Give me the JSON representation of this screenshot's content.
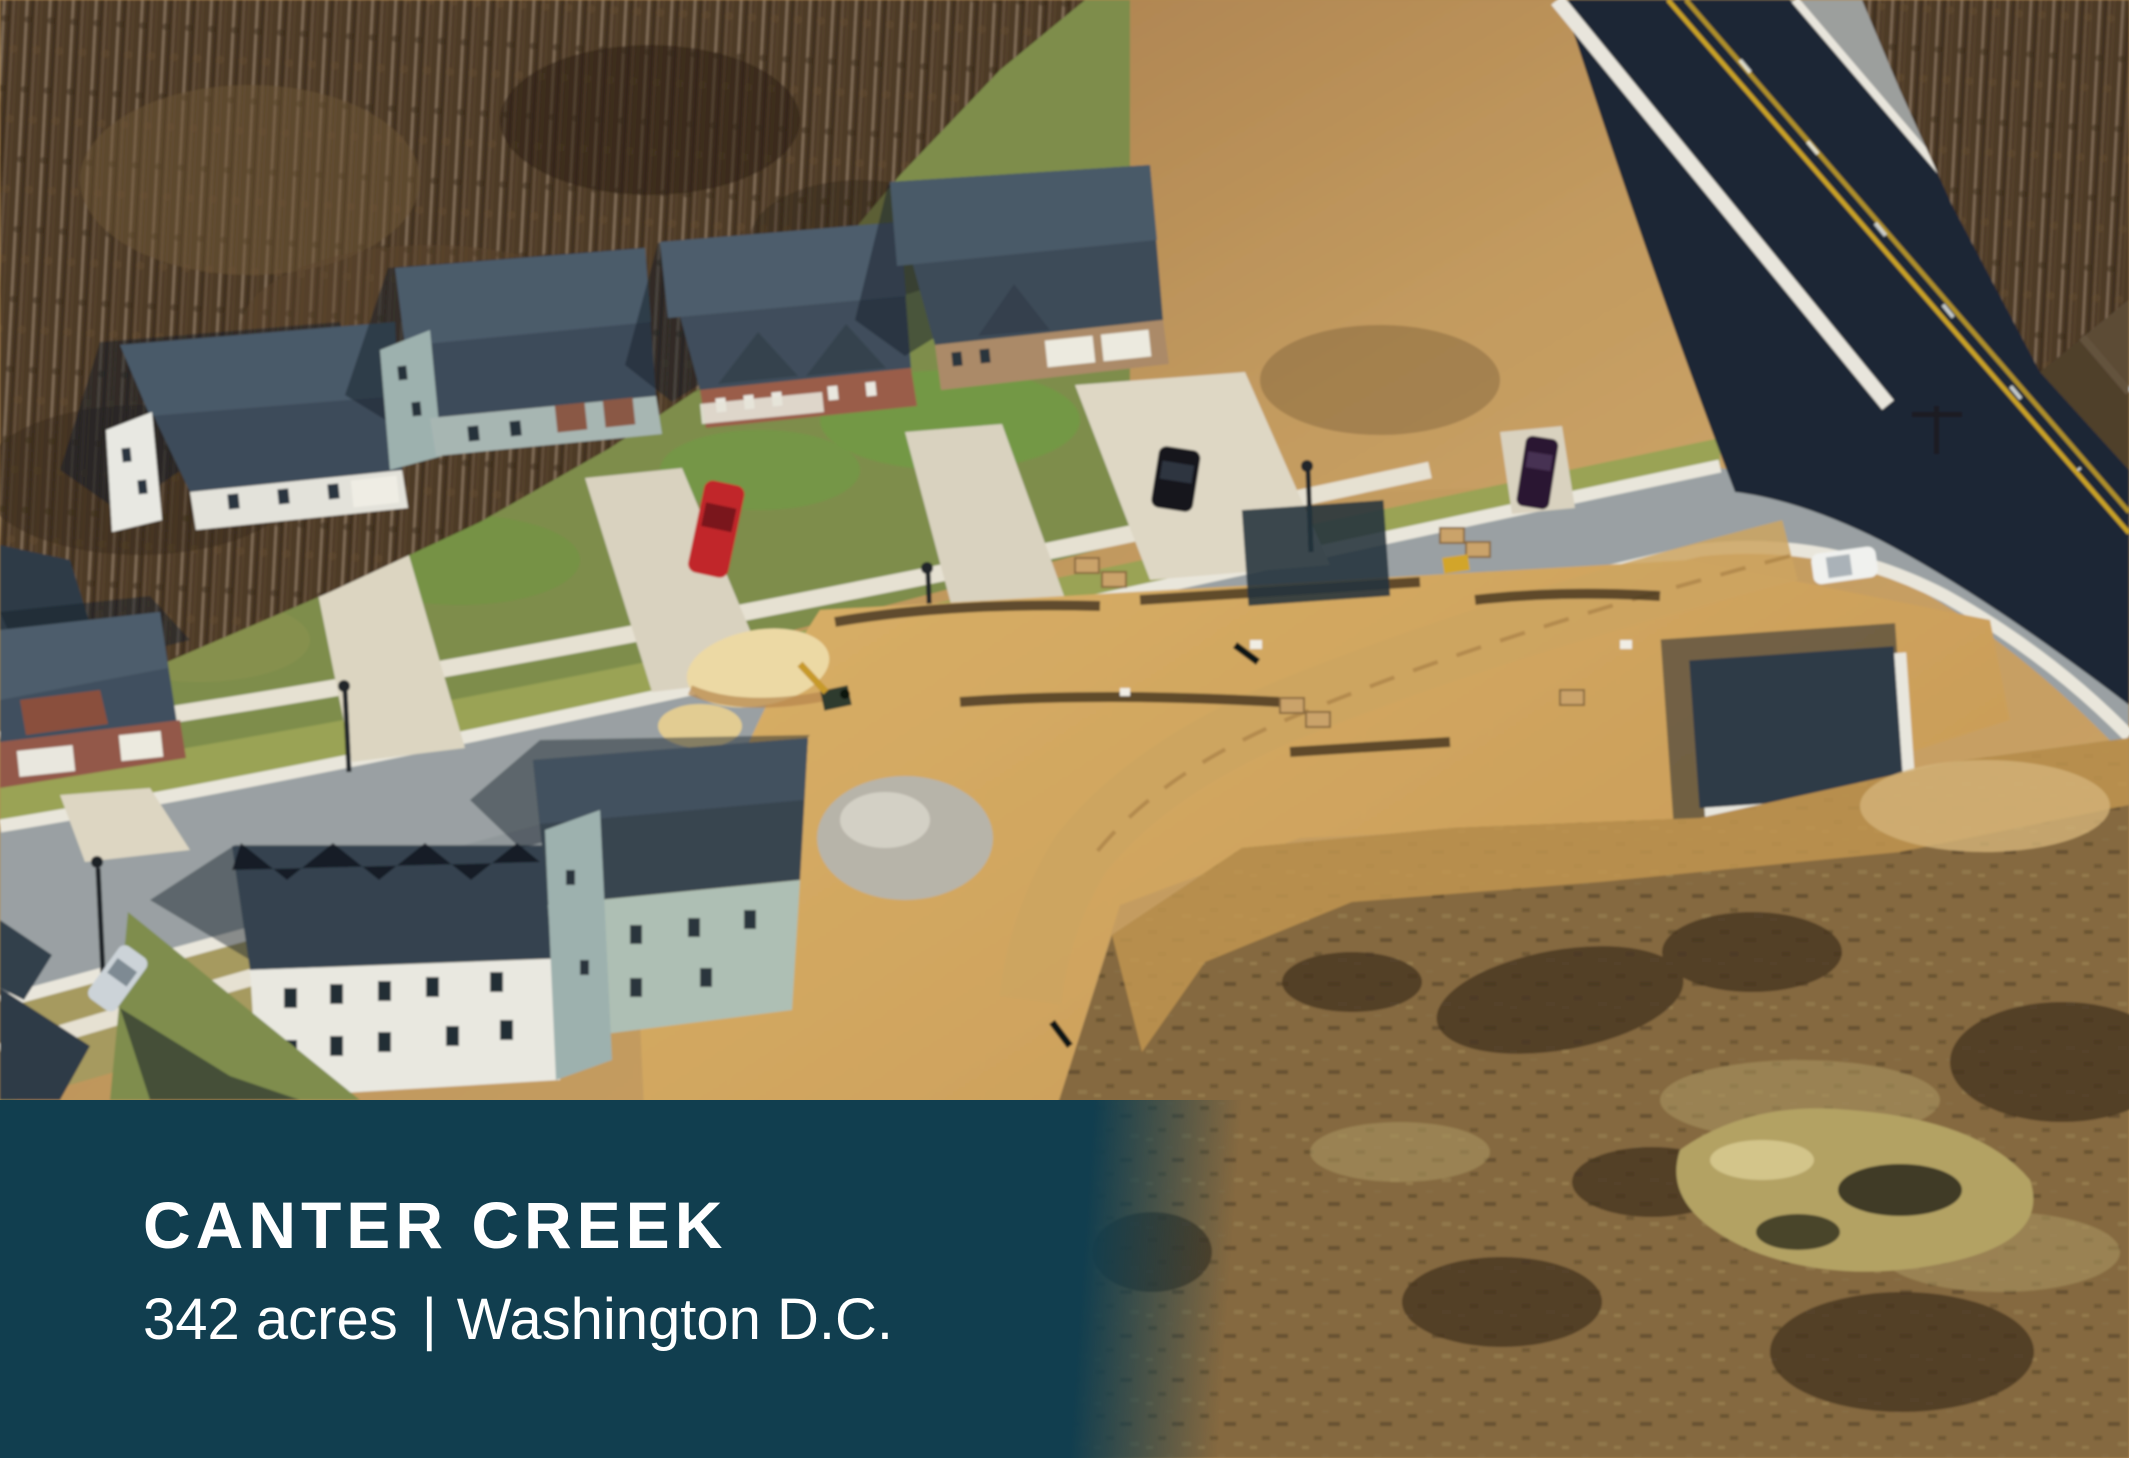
{
  "caption_panel": {
    "title": "CANTER CREEK",
    "stats": {
      "acreage": "342 acres",
      "separator": "|",
      "location": "Washington D.C."
    },
    "colors": {
      "background": "#113e4f",
      "text": "#ffffff"
    }
  },
  "photo": {
    "kind": "aerial-photograph",
    "scene": "Suburban homes along a street beside a highway, graded construction lots with sand piles and materials, bare winter woods and rough brown fields"
  }
}
